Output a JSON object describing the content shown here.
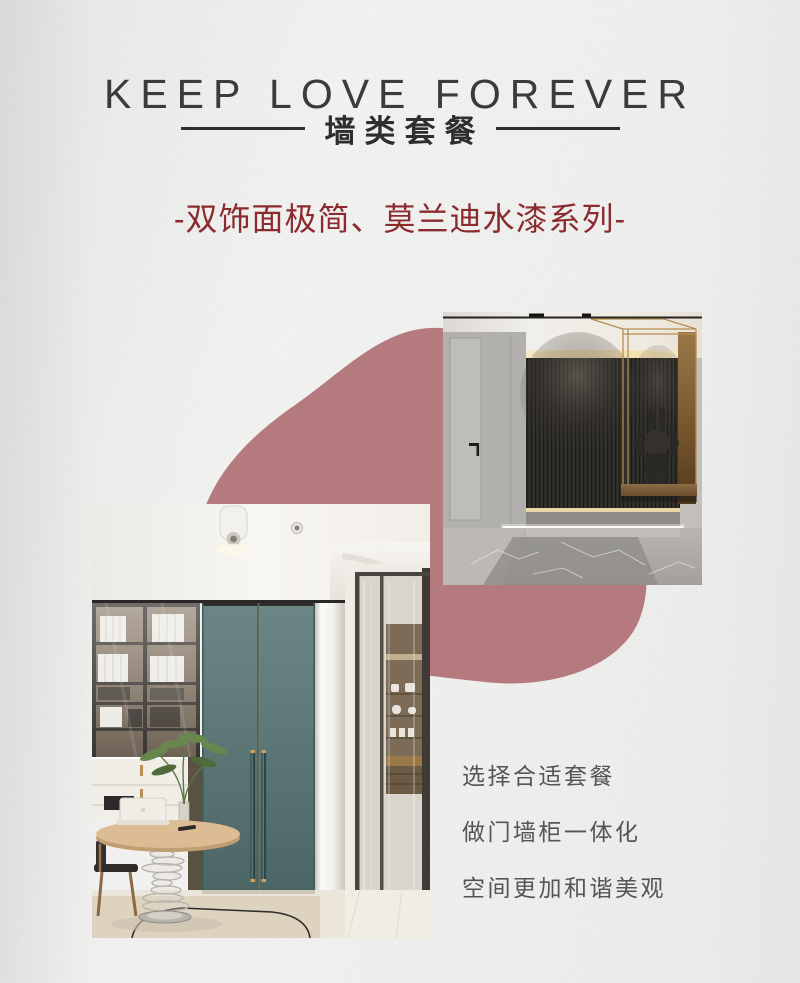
{
  "page": {
    "width_px": 800,
    "height_px": 983,
    "background_color": "#f2f2f1",
    "texture": "paper-grain"
  },
  "header": {
    "title": "KEEP LOVE FOREVER",
    "title_color": "#3b3b3d",
    "subtitle": "墙类套餐",
    "subtitle_color": "#2e2e30",
    "series_line": "-双饰面极简、莫兰迪水漆系列-",
    "series_color": "#8b2b2f"
  },
  "decor": {
    "blob_color": "#b47a7e",
    "blob_shape": "organic-rounded"
  },
  "photos": {
    "entryway": {
      "alt": "入户玄关效果图：灰色门墙板、黑色格栅背景墙、金色置物架与黑色兔子摆件",
      "position": "top-right"
    },
    "living": {
      "alt": "客厅效果图：玻璃书柜、灰绿色双开门、玻璃旋转底座圆桌与绿植",
      "position": "bottom-left"
    }
  },
  "benefits": [
    "选择合适套餐",
    "做门墙柜一体化",
    "空间更加和谐美观"
  ],
  "benefits_color": "#54545a"
}
